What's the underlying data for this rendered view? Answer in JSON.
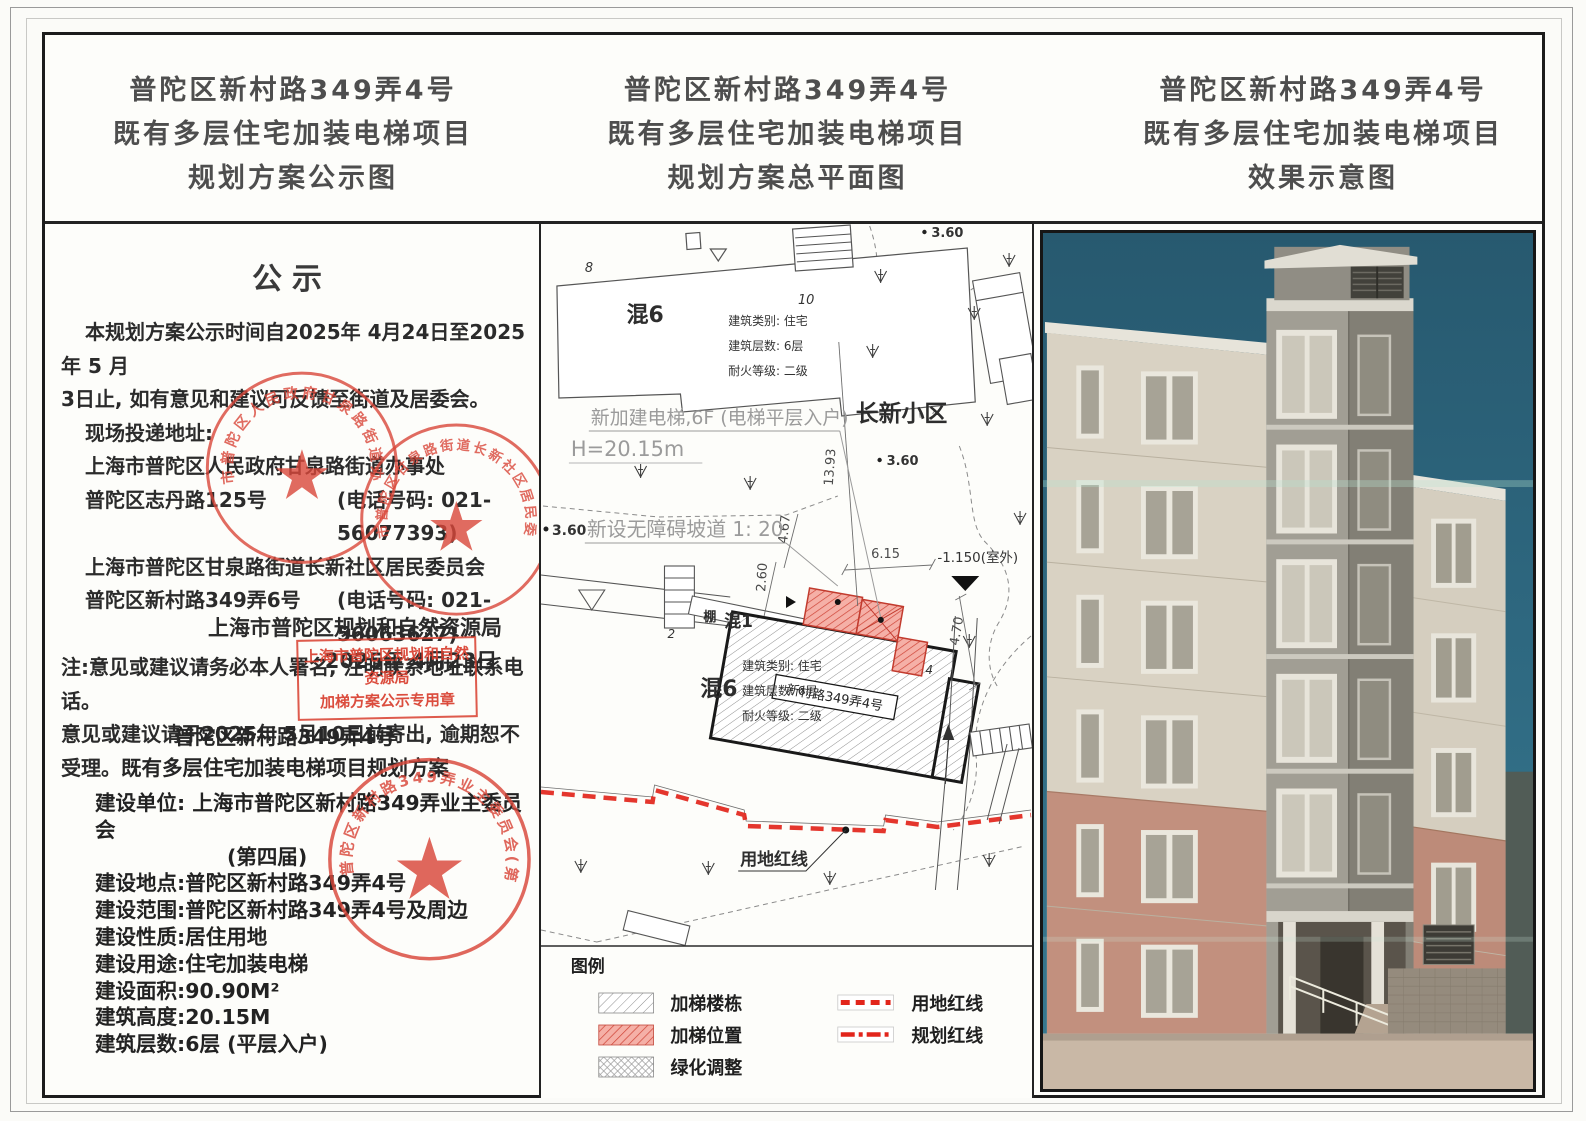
{
  "titles": {
    "left": [
      "普陀区新村路349弄4号",
      "既有多层住宅加装电梯项目",
      "规划方案公示图"
    ],
    "middle": [
      "普陀区新村路349弄4号",
      "既有多层住宅加装电梯项目",
      "规划方案总平面图"
    ],
    "right": [
      "普陀区新村路349弄4号",
      "既有多层住宅加装电梯项目",
      "效果示意图"
    ]
  },
  "notice": {
    "heading": "公示",
    "para": [
      "本规划方案公示时间自2025年 4月24日至2025年 5 月",
      "3日止, 如有意见和建议可反馈至街道及居委会。",
      "现场投递地址:",
      "上海市普陀区人民政府甘泉路街道办事处"
    ],
    "addr1": {
      "name": "普陀区志丹路125号",
      "phone": "(电话号码: 021-56077393)"
    },
    "addr2_header": "上海市普陀区甘泉路街道长新社区居民委员会",
    "addr2": {
      "name": "普陀区新村路349弄6号",
      "phone": "(电话号码: 021-56063627)"
    },
    "note": [
      "注:意见或建议请务必本人署名, 注明联系地址联系电话。",
      "意见或建议请于2025年 5月10日前寄出, 逾期恕不受理。"
    ],
    "authority": "上海市普陀区规划和自然资源局",
    "date": "2025年 4月23日",
    "subtitle": [
      "普陀区新村路349弄4号",
      "既有多层住宅加装电梯项目规划方案"
    ],
    "details": [
      "建设单位: 上海市普陀区新村路349弄业主委员会",
      "(第四届)",
      "建设地点:普陀区新村路349弄4号",
      "建设范围:普陀区新村路349弄4号及周边",
      "建设性质:居住用地",
      "建设用途:住宅加装电梯",
      "建设面积:90.90M²",
      "建筑高度:20.15M",
      "建筑层数:6层 (平层入户)"
    ]
  },
  "stamps": {
    "round1": "上海市普陀区人民政府甘泉路街道办事处",
    "round2": "上海市普陀区甘泉路街道长新社区居民委员会",
    "round3": "上海市普陀区新村路349弄业主委员会(第四届)",
    "box": [
      "上海市普陀区规划和自然资源局",
      "加梯方案公示专用章"
    ]
  },
  "plan": {
    "spot_elevation": "3.60",
    "bldg_no_8": "8",
    "bldg_no_10": "10",
    "bldg_no_2": "2",
    "bldg_no_4": "4",
    "hun6": "混6",
    "hun1": "混1",
    "peng": "棚",
    "anno": [
      "建筑类别: 住宅",
      "建筑层数: 6层",
      "耐火等级: 二级"
    ],
    "elevator_note": "新加建电梯,6F (电梯平层入户)",
    "height_note": "H=20.15m",
    "estate_name": "长新小区",
    "ramp_note": "新设无障碍坡道 1: 20",
    "outdoor_level": "-1.150(室外)",
    "dims": {
      "a": "13.93",
      "b": "4.67",
      "c": "2.60",
      "d": "6.15",
      "e": "4.70"
    },
    "main_building_label": "新村路349弄4号",
    "redline_label": "用地红线",
    "legend": {
      "title": "图例",
      "items": [
        "加梯楼栋",
        "加梯位置",
        "绿化调整",
        "用地红线",
        "规划红线"
      ]
    }
  },
  "colors": {
    "stamp_red": "#d9473a",
    "redline_red": "#e2251b",
    "elevator_hatch_bg": "#f5b0a7",
    "sky_teal": "#2e6880"
  }
}
